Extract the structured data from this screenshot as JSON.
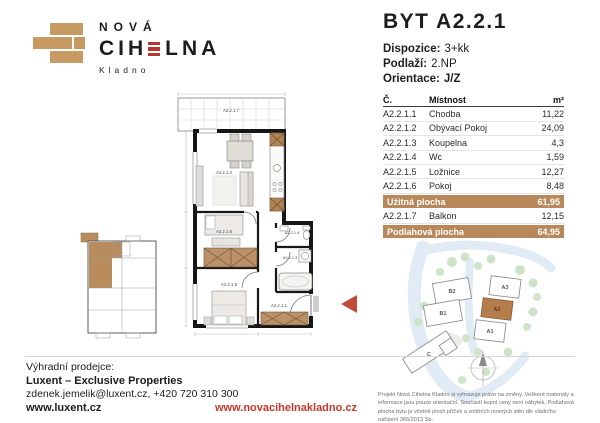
{
  "brand": {
    "line1": "NOVÁ",
    "word_pre": "CIH",
    "word_post": "LNA",
    "city": "Kladno"
  },
  "header": {
    "title": "BYT A2.2.1",
    "spec1_label": "Dispozice:",
    "spec1_value": "3+kk",
    "spec2_label": "Podlaží:",
    "spec2_value": "2.NP",
    "spec3_label": "Orientace:",
    "spec3_value": "J/Z"
  },
  "table": {
    "col_no": "Č.",
    "col_room": "Místnost",
    "col_area": "m²",
    "rows": [
      {
        "no": "A2.2.1.1",
        "room": "Chodba",
        "area": "11,22"
      },
      {
        "no": "A2.2.1.2",
        "room": "Obývací Pokoj",
        "area": "24,09"
      },
      {
        "no": "A2.2.1.3",
        "room": "Koupelna",
        "area": "4,3"
      },
      {
        "no": "A2.2.1.4",
        "room": "Wc",
        "area": "1,59"
      },
      {
        "no": "A2.2.1.5",
        "room": "Ložnice",
        "area": "12,27"
      },
      {
        "no": "A2.2.1.6",
        "room": "Pokoj",
        "area": "8,48"
      }
    ],
    "summary1": {
      "label": "Užitná plocha",
      "value": "61,95"
    },
    "balcony_row": {
      "no": "A2.2.1.7",
      "room": "Balkon",
      "area": "12,15"
    },
    "summary2": {
      "label": "Podlahová plocha",
      "value": "64,95"
    }
  },
  "floorplan": {
    "labels": {
      "balcony": "A2.2.1.7",
      "living": "A2.2.1.2",
      "room": "A2.2.1.6",
      "bedroom": "A2.2.1.5",
      "hall": "A2.2.1.1",
      "wc": "A2.2.1.4",
      "bath": "A2.2.1.3"
    }
  },
  "siteplan": {
    "buildings": [
      {
        "label": "B2"
      },
      {
        "label": "B1"
      },
      {
        "label": "A3"
      },
      {
        "label": "A2"
      },
      {
        "label": "A1"
      },
      {
        "label": "C"
      }
    ]
  },
  "footer": {
    "exclusive": "Výhradní prodejce:",
    "agency": "Luxent – Exclusive Properties",
    "contact": "zdenek.jemelik@luxent.cz, +420 720 310 300",
    "web": "www.luxent.cz",
    "project_web": "www.novacihelnakladno.cz",
    "disclaimer": "Projekt Nová Cihelna Kladno si vyhrazuje právo na změny. Veškeré materiály a informace jsou pouze orientační. Součástí kupní ceny není nábytek. Podlahová plocha bytu je včetně ploch příček a vnitřních nosných stěn dle vládního nařízení 366/2013 Sb."
  },
  "colors": {
    "brick": "#c79a63",
    "accent_red": "#b5372c",
    "table_highlight": "#b9885a",
    "site_highlight": "#b57c4c"
  }
}
